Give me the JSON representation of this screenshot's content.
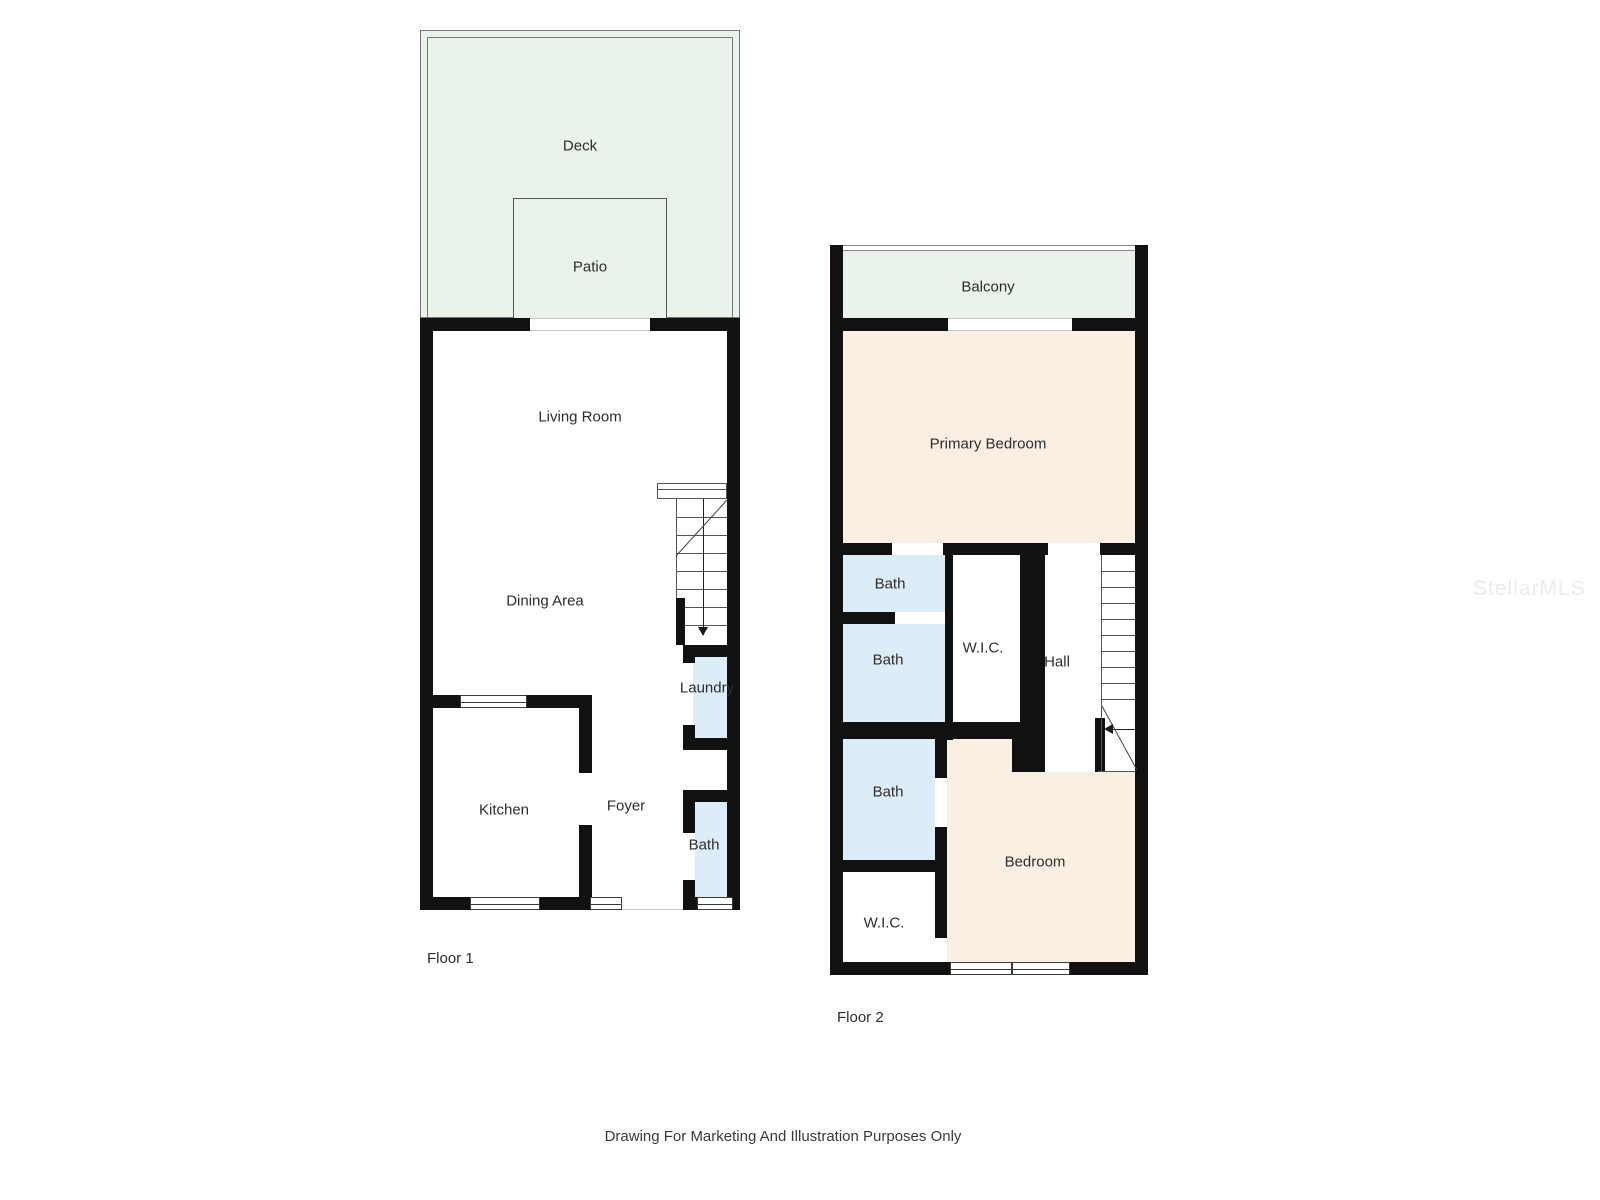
{
  "watermark": "StellarMLS",
  "disclaimer": "Drawing For Marketing And Illustration Purposes Only",
  "colors": {
    "outdoor": "#e9f3e9",
    "bedroom": "#f9efe3",
    "wet_room": "#ddedf8",
    "wall": "#111111"
  },
  "floor1": {
    "name": "Floor 1",
    "rooms": {
      "deck": "Deck",
      "patio": "Patio",
      "living_room": "Living Room",
      "dining_area": "Dining Area",
      "laundry": "Laundry",
      "kitchen": "Kitchen",
      "foyer": "Foyer",
      "bath": "Bath"
    }
  },
  "floor2": {
    "name": "Floor 2",
    "rooms": {
      "balcony": "Balcony",
      "primary_bedroom": "Primary Bedroom",
      "bath_1": "Bath",
      "bath_2": "Bath",
      "wic_1": "W.I.C.",
      "hall": "Hall",
      "bath_3": "Bath",
      "bedroom": "Bedroom",
      "wic_2": "W.I.C."
    }
  }
}
